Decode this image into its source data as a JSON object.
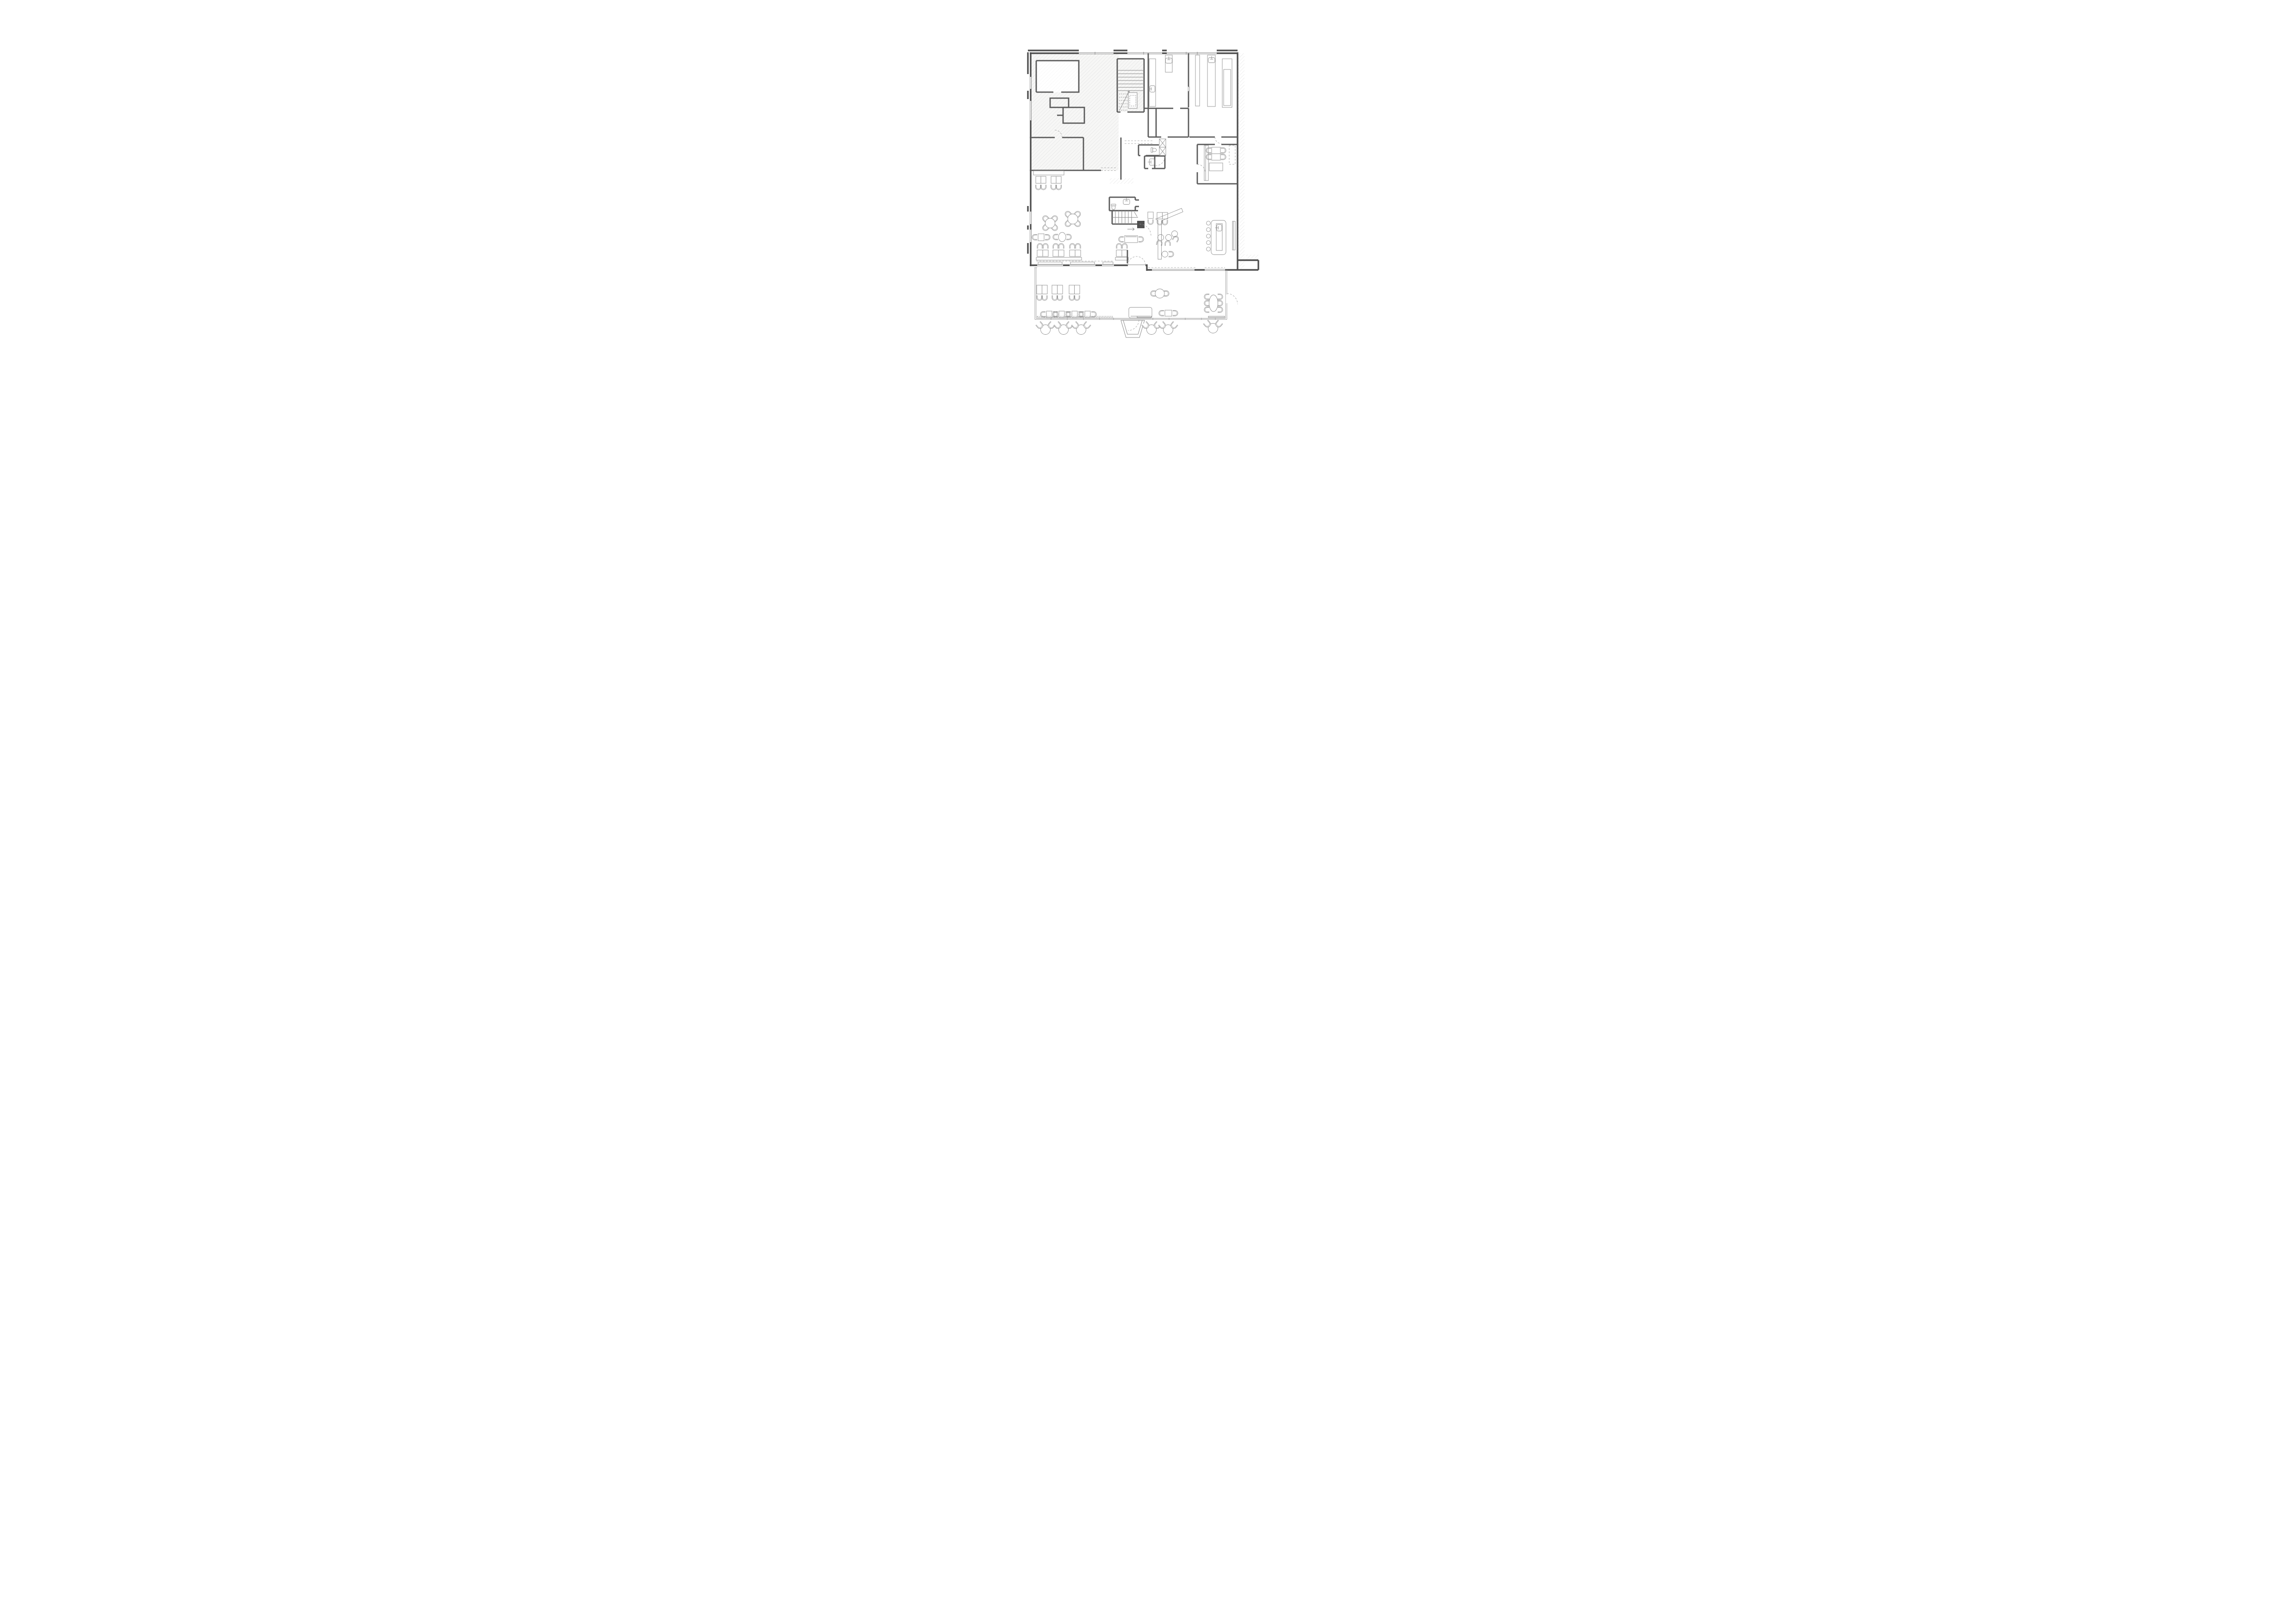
{
  "meta": {
    "drawing_type": "architectural-floor-plan",
    "level": "ground-floor-restaurant",
    "visible_text_labels": [],
    "line_style": "monochrome gray line drawing on white"
  },
  "colors": {
    "wall": "#4f4f4f",
    "inner": "#5a5a5a",
    "thin": "#8a8a8a",
    "furn": "#8f8f8f",
    "hatch": "#d7d7d7",
    "tint": "#f7f7f6",
    "dash": "#9a9a9a",
    "glass": "#9b9b9b",
    "bg": "#ffffff"
  },
  "regions": [
    {
      "name": "existing-building-zone",
      "fill": "diagonal-hatch",
      "contains": [
        "two enclosed rooms",
        "corridor band"
      ]
    },
    {
      "name": "stairwell",
      "contains": [
        "straight flight",
        "return flight dashed",
        "platform lift",
        "handrail diagonal"
      ]
    },
    {
      "name": "kitchen",
      "contains": [
        "five worktop counters",
        "three sinks",
        "dividing wall with door"
      ]
    },
    {
      "name": "wc-cluster",
      "contains": [
        "two wc rooms",
        "two x-marked shafts",
        "toilet",
        "wash-basin",
        "door swing arcs"
      ]
    },
    {
      "name": "staff-room",
      "contains": [
        "two tables",
        "four chairs",
        "wall counter",
        "dashed cabinet"
      ]
    },
    {
      "name": "dining-room",
      "contains": [
        "west banquette with four tables",
        "two round four-seat tables",
        "two two-seat tables",
        "south banquette row with eight tables"
      ]
    },
    {
      "name": "entrance-hall",
      "contains": [
        "down stair",
        "lavatory with toilet and basin",
        "three tables",
        "console table",
        "double entry doors"
      ]
    },
    {
      "name": "lounge",
      "contains": [
        "angled bench",
        "four round side tables",
        "bar counter",
        "five bar stools",
        "wall counter"
      ]
    },
    {
      "name": "winter-garden",
      "contains": [
        "glazed walls",
        "three double tables",
        "four small tables",
        "round table",
        "oval six-seat table",
        "planter bench",
        "garden door"
      ]
    },
    {
      "name": "terrace",
      "contains": [
        "six round tables",
        "twelve tub chairs",
        "entry walkway"
      ]
    },
    {
      "name": "neighbour-strip",
      "fill": "diagonal-hatch"
    }
  ],
  "furniture_inventory": {
    "round_tables_4_seats": 2,
    "round_tables_2_seats": 8,
    "square_table_pairs": 9,
    "small_two_seat_tables": 7,
    "oval_table_6_seats": 1,
    "bar_stools": 5,
    "kitchen_counters": 5,
    "sinks": 5,
    "toilets": 3,
    "ventilation_shafts": 2,
    "terrace_tables": 6,
    "terrace_tub_chairs": 12
  },
  "icons": [
    {
      "name": "stair-up-arrow-icon",
      "meaning": "direction of stair run"
    },
    {
      "name": "door-swing-arc-icon",
      "meaning": "door opening direction"
    },
    {
      "name": "x-shaft-icon",
      "meaning": "vertical duct / shaft"
    }
  ]
}
